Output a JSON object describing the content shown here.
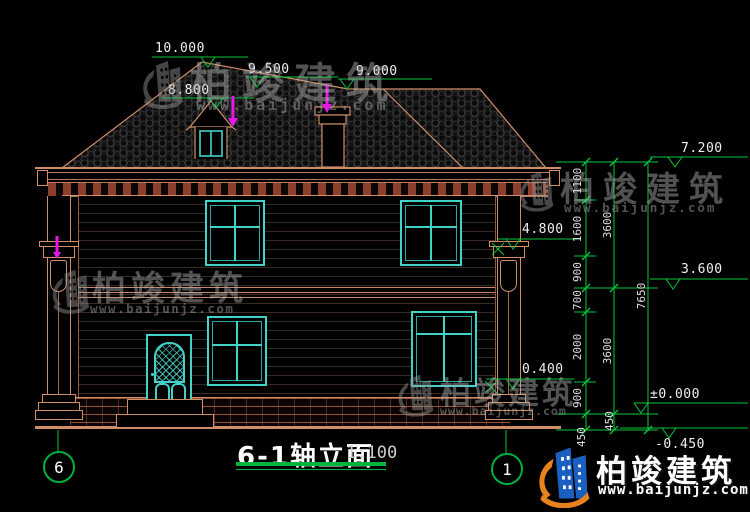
{
  "title": {
    "name": "6-1轴立面",
    "scale": "1:100"
  },
  "axis_bubbles": {
    "left": "6",
    "right": "1"
  },
  "markers": {
    "m10000": "10.000",
    "m9500": "9.500",
    "m9000": "9.000",
    "m8800": "8.800",
    "m7200": "7.200",
    "m4800": "4.800",
    "m3600": "3.600",
    "m0400": "0.400",
    "m0000": "±0.000",
    "mneg0450": "-0.450"
  },
  "dims": {
    "inner": [
      "1100",
      "1600",
      "900",
      "700",
      "2000",
      "900",
      "450"
    ],
    "middle": [
      "3600",
      "3600",
      "450"
    ],
    "overall": "7650"
  },
  "watermark": {
    "brand": "柏竣建筑",
    "url": "www.baijunjz.com"
  },
  "colors": {
    "annotation_green": "#00c83c",
    "line_tan": "#cf8d68",
    "window_cyan": "#41d2c8",
    "highlight_magenta": "#e518e5",
    "logo_blue": "#1b5fc0",
    "logo_orange": "#e8821c"
  }
}
